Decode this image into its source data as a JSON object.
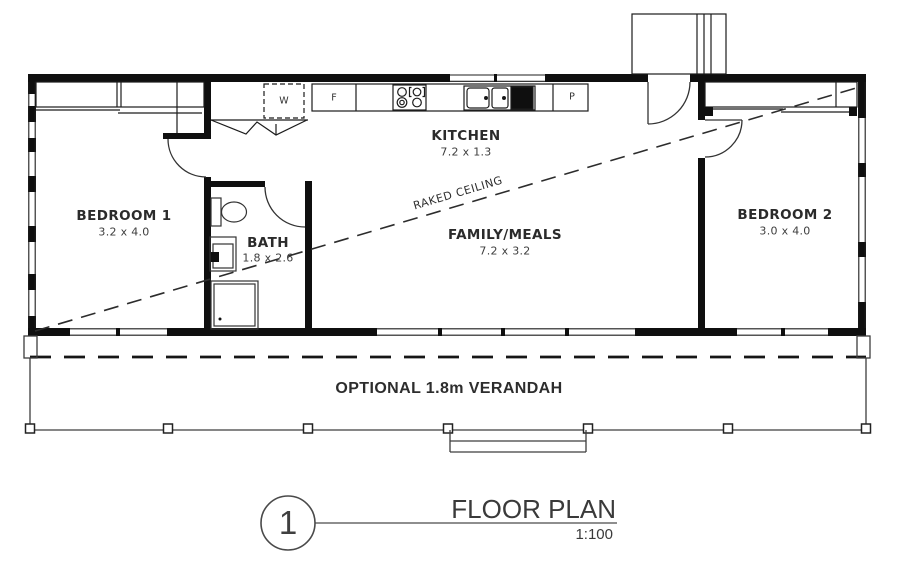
{
  "page": {
    "background": "#ffffff",
    "wall_color": "#0f0f0f",
    "text_color": "#2b2b2b"
  },
  "rooms": {
    "bedroom1": {
      "name": "BEDROOM 1",
      "dims": "3.2 x 4.0"
    },
    "bath": {
      "name": "BATH",
      "dims": "1.8 x 2.6"
    },
    "kitchen": {
      "name": "KITCHEN",
      "dims": "7.2 x 1.3"
    },
    "family": {
      "name": "FAMILY/MEALS",
      "dims": "7.2 x 3.2"
    },
    "bedroom2": {
      "name": "BEDROOM 2",
      "dims": "3.0 x 4.0"
    }
  },
  "fixtures": {
    "washer": "W",
    "fridge": "F",
    "pantry": "P"
  },
  "annotations": {
    "raked_ceiling": "RAKED CEILING",
    "verandah": "OPTIONAL 1.8m VERANDAH"
  },
  "title_block": {
    "drawing_number": "1",
    "title": "FLOOR PLAN",
    "scale": "1:100"
  }
}
